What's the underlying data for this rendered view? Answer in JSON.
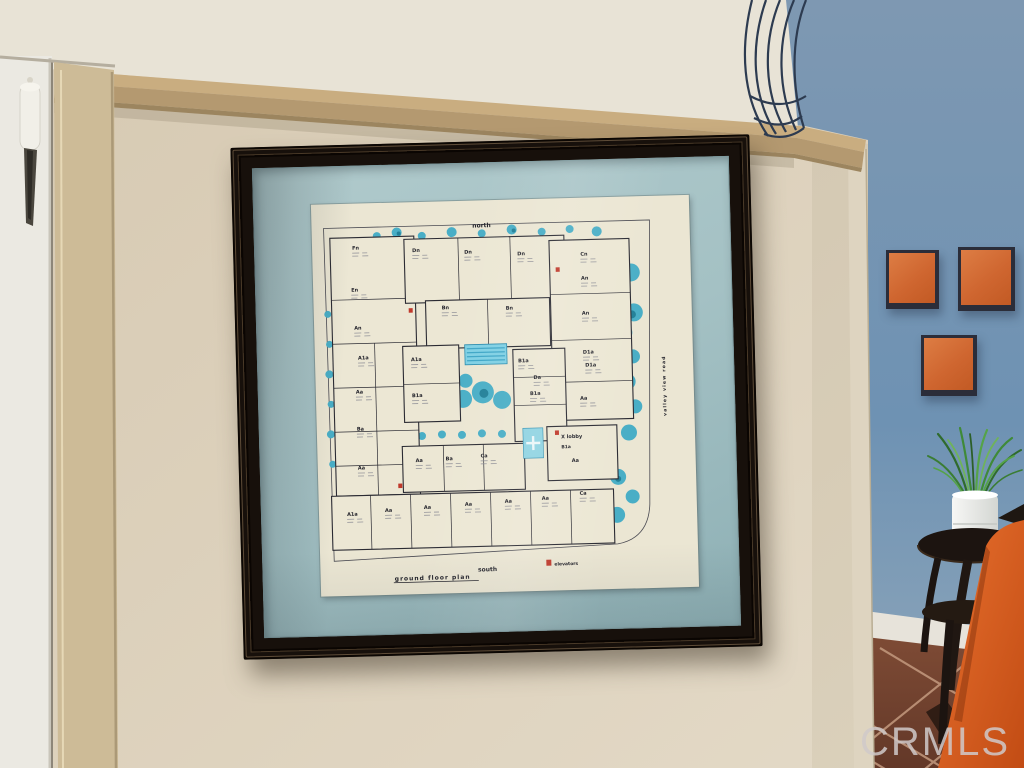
{
  "room": {
    "watermark": "CRMLS",
    "colors": {
      "wall_tan": "#d9ccb6",
      "wall_blue": "#6e92b3",
      "ledge_tan": "#b49970",
      "frame_dark": "#17100b",
      "mat_blue": "#a4c1c4",
      "paper_cream": "#ebe6d3",
      "art_orange": "#cf6630",
      "chair_orange": "#d8571f",
      "tile_brown": "#74422f",
      "landscaping_teal": "#49aec6",
      "pool_blue": "#7fd0e4",
      "elevator_red": "#c0392b"
    }
  },
  "floor_plan": {
    "titles": {
      "north": "north",
      "south": "south",
      "ground_floor_plan": "ground   floor   plan",
      "elevators": "elevators",
      "road": "valley view road"
    },
    "lobby": {
      "label": "X  lobby",
      "sub": "B1a",
      "unit": "Aa"
    },
    "units": [
      {
        "code": "Fn",
        "x": 40,
        "y": 46
      },
      {
        "code": "Dn",
        "x": 100,
        "y": 50
      },
      {
        "code": "Dn",
        "x": 152,
        "y": 53
      },
      {
        "code": "Dn",
        "x": 205,
        "y": 56
      },
      {
        "code": "Cn",
        "x": 268,
        "y": 58
      },
      {
        "code": "En",
        "x": 38,
        "y": 88
      },
      {
        "code": "An",
        "x": 268,
        "y": 82
      },
      {
        "code": "Bn",
        "x": 128,
        "y": 108
      },
      {
        "code": "Bn",
        "x": 192,
        "y": 110
      },
      {
        "code": "An",
        "x": 40,
        "y": 126
      },
      {
        "code": "An",
        "x": 268,
        "y": 117
      },
      {
        "code": "A1a",
        "x": 43,
        "y": 156
      },
      {
        "code": "A1a",
        "x": 96,
        "y": 159
      },
      {
        "code": "B1a",
        "x": 203,
        "y": 163
      },
      {
        "code": "D1a",
        "x": 268,
        "y": 156
      },
      {
        "code": "Da",
        "x": 218,
        "y": 180
      },
      {
        "code": "D1a",
        "x": 270,
        "y": 169
      },
      {
        "code": "B1a",
        "x": 214,
        "y": 196
      },
      {
        "code": "Aa",
        "x": 40,
        "y": 190
      },
      {
        "code": "B1a",
        "x": 96,
        "y": 195
      },
      {
        "code": "Aa",
        "x": 264,
        "y": 202
      },
      {
        "code": "Ba",
        "x": 40,
        "y": 227
      },
      {
        "code": "Aa",
        "x": 40,
        "y": 266
      },
      {
        "code": "Aa",
        "x": 98,
        "y": 260
      },
      {
        "code": "Ba",
        "x": 128,
        "y": 259
      },
      {
        "code": "Ca",
        "x": 163,
        "y": 257
      },
      {
        "code": "A1a",
        "x": 28,
        "y": 312
      },
      {
        "code": "Aa",
        "x": 66,
        "y": 309
      },
      {
        "code": "Aa",
        "x": 105,
        "y": 307
      },
      {
        "code": "Aa",
        "x": 146,
        "y": 305
      },
      {
        "code": "Aa",
        "x": 186,
        "y": 303
      },
      {
        "code": "Aa",
        "x": 223,
        "y": 301
      },
      {
        "code": "Ca",
        "x": 261,
        "y": 297
      }
    ]
  }
}
